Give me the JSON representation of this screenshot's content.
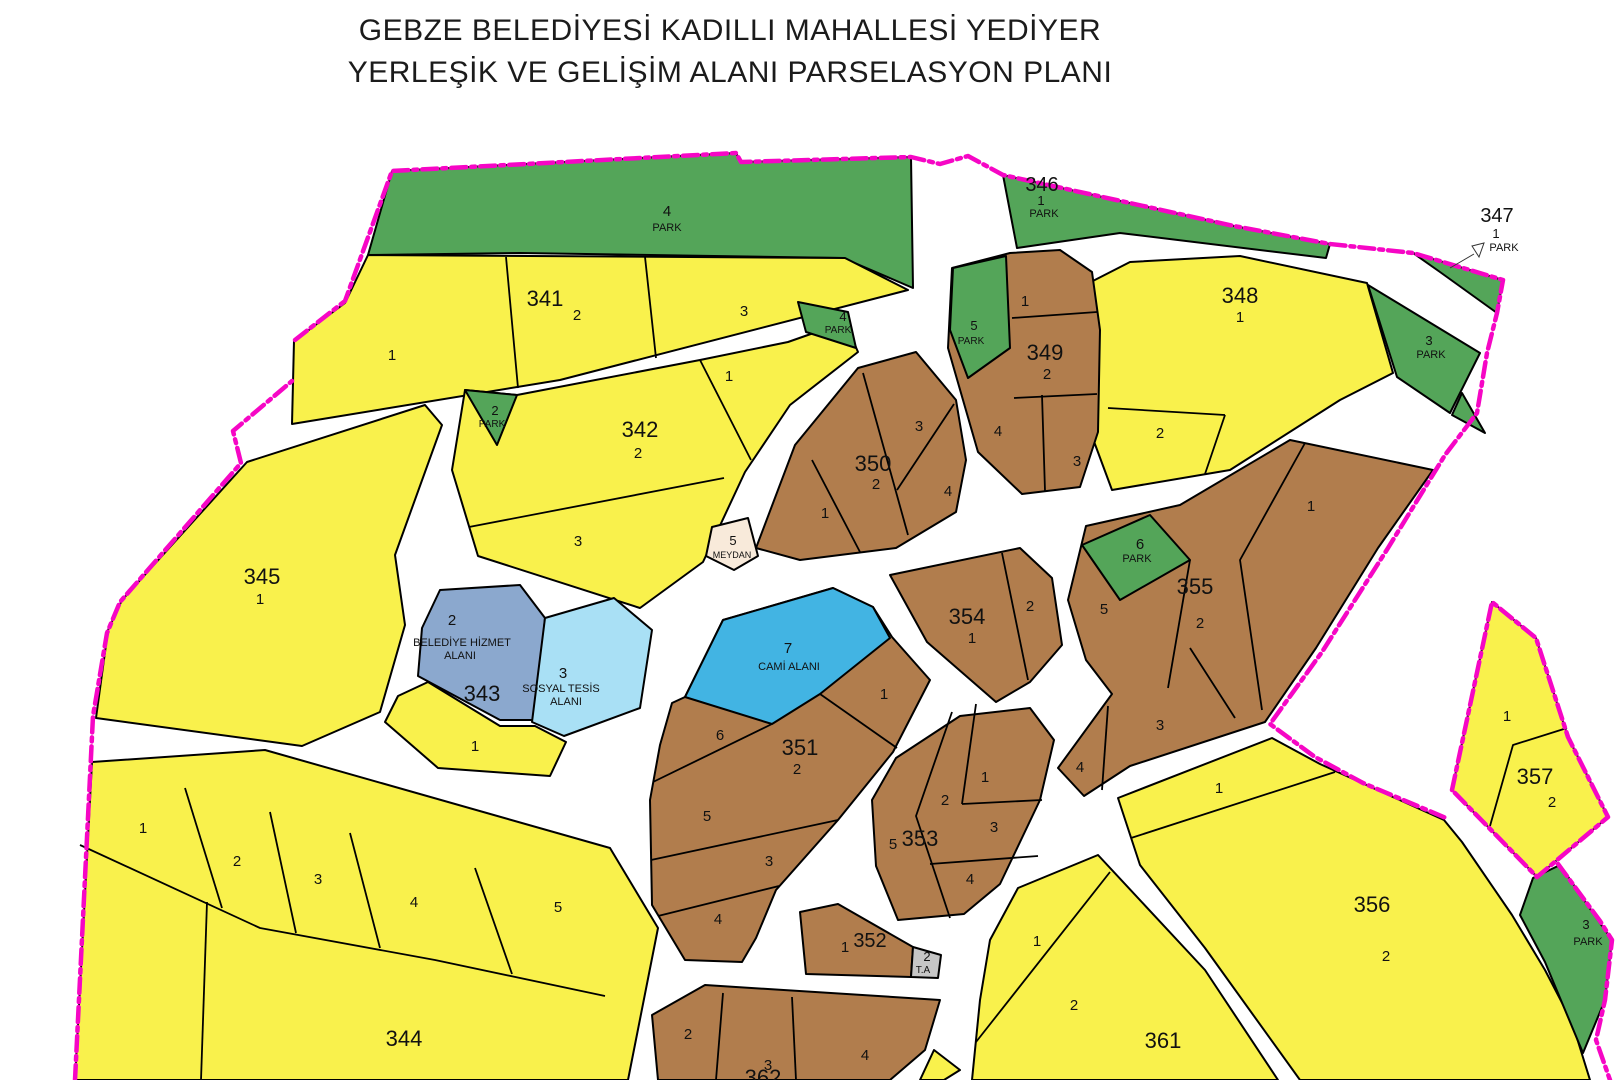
{
  "title": {
    "line1": "GEBZE BELEDİYESİ KADILLI MAHALLESİ YEDİYER",
    "line2": "YERLEŞİK VE GELİŞİM ALANI PARSELASYON PLANI"
  },
  "palette": {
    "residential_yellow": "#F9F14C",
    "built_brown": "#B17D4D",
    "park_green": "#54A559",
    "mosque_blue": "#42B4E3",
    "social_facility_lightblue": "#A9E0F5",
    "municipal_service_bluegray": "#8BA8CE",
    "square_cream": "#F8EADA",
    "transformer_gray": "#C6C6C6",
    "boundary_magenta": "#F606C5",
    "road_white": "#FFFFFF",
    "line_black": "#000000"
  },
  "map": {
    "labels": [
      {
        "t": "4",
        "x": 667,
        "y": 216,
        "fs": 15
      },
      {
        "t": "PARK",
        "x": 667,
        "y": 231,
        "fs": 11
      },
      {
        "t": "346",
        "x": 1042,
        "y": 191,
        "fs": 20
      },
      {
        "t": "1",
        "x": 1041,
        "y": 205,
        "fs": 13
      },
      {
        "t": "PARK",
        "x": 1044,
        "y": 217,
        "fs": 11
      },
      {
        "t": "347",
        "x": 1497,
        "y": 222,
        "fs": 20
      },
      {
        "t": "1",
        "x": 1496,
        "y": 238,
        "fs": 13
      },
      {
        "t": "PARK",
        "x": 1504,
        "y": 251,
        "fs": 11
      },
      {
        "t": "341",
        "x": 545,
        "y": 306,
        "fs": 22
      },
      {
        "t": "2",
        "x": 577,
        "y": 320,
        "fs": 15
      },
      {
        "t": "1",
        "x": 392,
        "y": 360,
        "fs": 15
      },
      {
        "t": "3",
        "x": 744,
        "y": 316,
        "fs": 15
      },
      {
        "t": "348",
        "x": 1240,
        "y": 303,
        "fs": 22
      },
      {
        "t": "1",
        "x": 1240,
        "y": 322,
        "fs": 15
      },
      {
        "t": "2",
        "x": 1160,
        "y": 438,
        "fs": 15
      },
      {
        "t": "3",
        "x": 1429,
        "y": 345,
        "fs": 13
      },
      {
        "t": "PARK",
        "x": 1431,
        "y": 358,
        "fs": 11
      },
      {
        "t": "4",
        "x": 843,
        "y": 321,
        "fs": 13
      },
      {
        "t": "PARK",
        "x": 838,
        "y": 333,
        "fs": 10
      },
      {
        "t": "5",
        "x": 974,
        "y": 330,
        "fs": 13
      },
      {
        "t": "PARK",
        "x": 971,
        "y": 344,
        "fs": 10
      },
      {
        "t": "349",
        "x": 1045,
        "y": 360,
        "fs": 22
      },
      {
        "t": "2",
        "x": 1047,
        "y": 379,
        "fs": 15
      },
      {
        "t": "1",
        "x": 1025,
        "y": 306,
        "fs": 15
      },
      {
        "t": "4",
        "x": 998,
        "y": 436,
        "fs": 15
      },
      {
        "t": "3",
        "x": 1077,
        "y": 466,
        "fs": 15
      },
      {
        "t": "342",
        "x": 640,
        "y": 437,
        "fs": 22
      },
      {
        "t": "2",
        "x": 638,
        "y": 458,
        "fs": 15
      },
      {
        "t": "1",
        "x": 729,
        "y": 381,
        "fs": 15
      },
      {
        "t": "3",
        "x": 578,
        "y": 546,
        "fs": 15
      },
      {
        "t": "2",
        "x": 495,
        "y": 415,
        "fs": 13
      },
      {
        "t": "PARK",
        "x": 492,
        "y": 427,
        "fs": 10
      },
      {
        "t": "350",
        "x": 873,
        "y": 471,
        "fs": 22
      },
      {
        "t": "2",
        "x": 876,
        "y": 489,
        "fs": 15
      },
      {
        "t": "3",
        "x": 919,
        "y": 431,
        "fs": 15
      },
      {
        "t": "1",
        "x": 825,
        "y": 518,
        "fs": 15
      },
      {
        "t": "4",
        "x": 948,
        "y": 496,
        "fs": 15
      },
      {
        "t": "5",
        "x": 733,
        "y": 545,
        "fs": 13
      },
      {
        "t": "MEYDAN",
        "x": 732,
        "y": 558,
        "fs": 9
      },
      {
        "t": "345",
        "x": 262,
        "y": 584,
        "fs": 22
      },
      {
        "t": "1",
        "x": 260,
        "y": 604,
        "fs": 15
      },
      {
        "t": "6",
        "x": 1140,
        "y": 549,
        "fs": 15
      },
      {
        "t": "PARK",
        "x": 1137,
        "y": 562,
        "fs": 11
      },
      {
        "t": "355",
        "x": 1195,
        "y": 594,
        "fs": 22
      },
      {
        "t": "2",
        "x": 1200,
        "y": 628,
        "fs": 15
      },
      {
        "t": "5",
        "x": 1104,
        "y": 614,
        "fs": 15
      },
      {
        "t": "1",
        "x": 1311,
        "y": 511,
        "fs": 15
      },
      {
        "t": "3",
        "x": 1160,
        "y": 730,
        "fs": 15
      },
      {
        "t": "4",
        "x": 1080,
        "y": 772,
        "fs": 15
      },
      {
        "t": "354",
        "x": 967,
        "y": 624,
        "fs": 22
      },
      {
        "t": "1",
        "x": 972,
        "y": 643,
        "fs": 15
      },
      {
        "t": "2",
        "x": 1030,
        "y": 611,
        "fs": 15
      },
      {
        "t": "7",
        "x": 788,
        "y": 653,
        "fs": 15
      },
      {
        "t": "CAMİ ALANI",
        "x": 789,
        "y": 670,
        "fs": 11
      },
      {
        "t": "351",
        "x": 800,
        "y": 755,
        "fs": 22
      },
      {
        "t": "2",
        "x": 797,
        "y": 774,
        "fs": 15
      },
      {
        "t": "6",
        "x": 720,
        "y": 740,
        "fs": 15
      },
      {
        "t": "1",
        "x": 884,
        "y": 699,
        "fs": 15
      },
      {
        "t": "5",
        "x": 707,
        "y": 821,
        "fs": 15
      },
      {
        "t": "3",
        "x": 769,
        "y": 866,
        "fs": 15
      },
      {
        "t": "4",
        "x": 718,
        "y": 924,
        "fs": 15
      },
      {
        "t": "2",
        "x": 452,
        "y": 625,
        "fs": 15
      },
      {
        "t": "BELEDİYE HİZMET",
        "x": 462,
        "y": 646,
        "fs": 11
      },
      {
        "t": "ALANI",
        "x": 460,
        "y": 659,
        "fs": 11
      },
      {
        "t": "343",
        "x": 482,
        "y": 701,
        "fs": 22
      },
      {
        "t": "3",
        "x": 563,
        "y": 678,
        "fs": 15
      },
      {
        "t": "SOSYAL TESİS",
        "x": 561,
        "y": 692,
        "fs": 11
      },
      {
        "t": "ALANI",
        "x": 566,
        "y": 705,
        "fs": 11
      },
      {
        "t": "1",
        "x": 475,
        "y": 751,
        "fs": 15
      },
      {
        "t": "1",
        "x": 143,
        "y": 833,
        "fs": 15
      },
      {
        "t": "2",
        "x": 237,
        "y": 866,
        "fs": 15
      },
      {
        "t": "3",
        "x": 318,
        "y": 884,
        "fs": 15
      },
      {
        "t": "4",
        "x": 414,
        "y": 907,
        "fs": 15
      },
      {
        "t": "5",
        "x": 558,
        "y": 912,
        "fs": 15
      },
      {
        "t": "344",
        "x": 404,
        "y": 1046,
        "fs": 22
      },
      {
        "t": "353",
        "x": 920,
        "y": 846,
        "fs": 22
      },
      {
        "t": "5",
        "x": 893,
        "y": 849,
        "fs": 15
      },
      {
        "t": "1",
        "x": 985,
        "y": 782,
        "fs": 15
      },
      {
        "t": "2",
        "x": 945,
        "y": 805,
        "fs": 15
      },
      {
        "t": "3",
        "x": 994,
        "y": 832,
        "fs": 15
      },
      {
        "t": "4",
        "x": 970,
        "y": 884,
        "fs": 15
      },
      {
        "t": "352",
        "x": 870,
        "y": 947,
        "fs": 20
      },
      {
        "t": "1",
        "x": 845,
        "y": 952,
        "fs": 15
      },
      {
        "t": "2",
        "x": 927,
        "y": 961,
        "fs": 13
      },
      {
        "t": "T.A",
        "x": 923,
        "y": 973,
        "fs": 10
      },
      {
        "t": "1",
        "x": 1037,
        "y": 946,
        "fs": 15
      },
      {
        "t": "2",
        "x": 1074,
        "y": 1010,
        "fs": 15
      },
      {
        "t": "361",
        "x": 1163,
        "y": 1048,
        "fs": 22
      },
      {
        "t": "2",
        "x": 688,
        "y": 1039,
        "fs": 15
      },
      {
        "t": "3",
        "x": 768,
        "y": 1070,
        "fs": 15
      },
      {
        "t": "362",
        "x": 763,
        "y": 1085,
        "fs": 22
      },
      {
        "t": "4",
        "x": 865,
        "y": 1060,
        "fs": 15
      },
      {
        "t": "356",
        "x": 1372,
        "y": 912,
        "fs": 22
      },
      {
        "t": "2",
        "x": 1386,
        "y": 961,
        "fs": 15
      },
      {
        "t": "1",
        "x": 1219,
        "y": 793,
        "fs": 15
      },
      {
        "t": "357",
        "x": 1535,
        "y": 784,
        "fs": 22
      },
      {
        "t": "2",
        "x": 1552,
        "y": 807,
        "fs": 15
      },
      {
        "t": "1",
        "x": 1507,
        "y": 721,
        "fs": 15
      },
      {
        "t": "3",
        "x": 1586,
        "y": 929,
        "fs": 13
      },
      {
        "t": "PARK",
        "x": 1588,
        "y": 945,
        "fs": 11
      }
    ]
  }
}
